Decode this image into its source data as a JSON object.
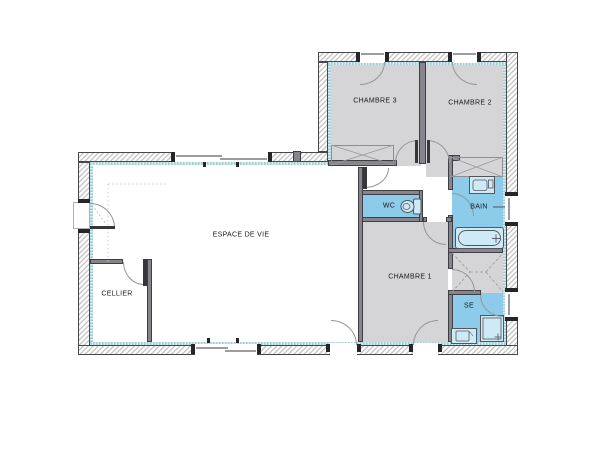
{
  "plan": {
    "rooms": {
      "chambre3": {
        "label": "CHAMBRE 3",
        "fill": "#d5d5d7"
      },
      "chambre2": {
        "label": "CHAMBRE 2",
        "fill": "#d5d5d7"
      },
      "chambre1": {
        "label": "CHAMBRE 1",
        "fill": "#d5d5d7"
      },
      "espace_de_vie": {
        "label": "ESPACE DE VIE",
        "fill": "#ffffff"
      },
      "cellier": {
        "label": "CELLIER",
        "fill": "#ffffff"
      },
      "wc": {
        "label": "WC",
        "fill": "#8ccbea"
      },
      "bain": {
        "label": "BAIN",
        "fill": "#8ccbea"
      },
      "se": {
        "label": "SE",
        "fill": "#8ccbea"
      }
    },
    "colors": {
      "exterior_wall_outline": "#46464b",
      "exterior_wall_hatch": "#c8c8ca",
      "interior_wall": "#84858d",
      "insulation_strip": "#b5d9de",
      "wet_room_fill": "#8ccbea",
      "bedroom_fill": "#d5d5d7",
      "fixture_fill": "#cfeaf7",
      "door_arc_stroke": "#96969a"
    },
    "fixtures": [
      {
        "icon": "toilet-icon",
        "room": "WC"
      },
      {
        "icon": "washbasin-icon",
        "room": "BAIN"
      },
      {
        "icon": "bathtub-icon",
        "room": "BAIN"
      },
      {
        "icon": "shower-icon",
        "room": "SE"
      },
      {
        "icon": "vanity-icon",
        "room": "SE"
      }
    ]
  }
}
